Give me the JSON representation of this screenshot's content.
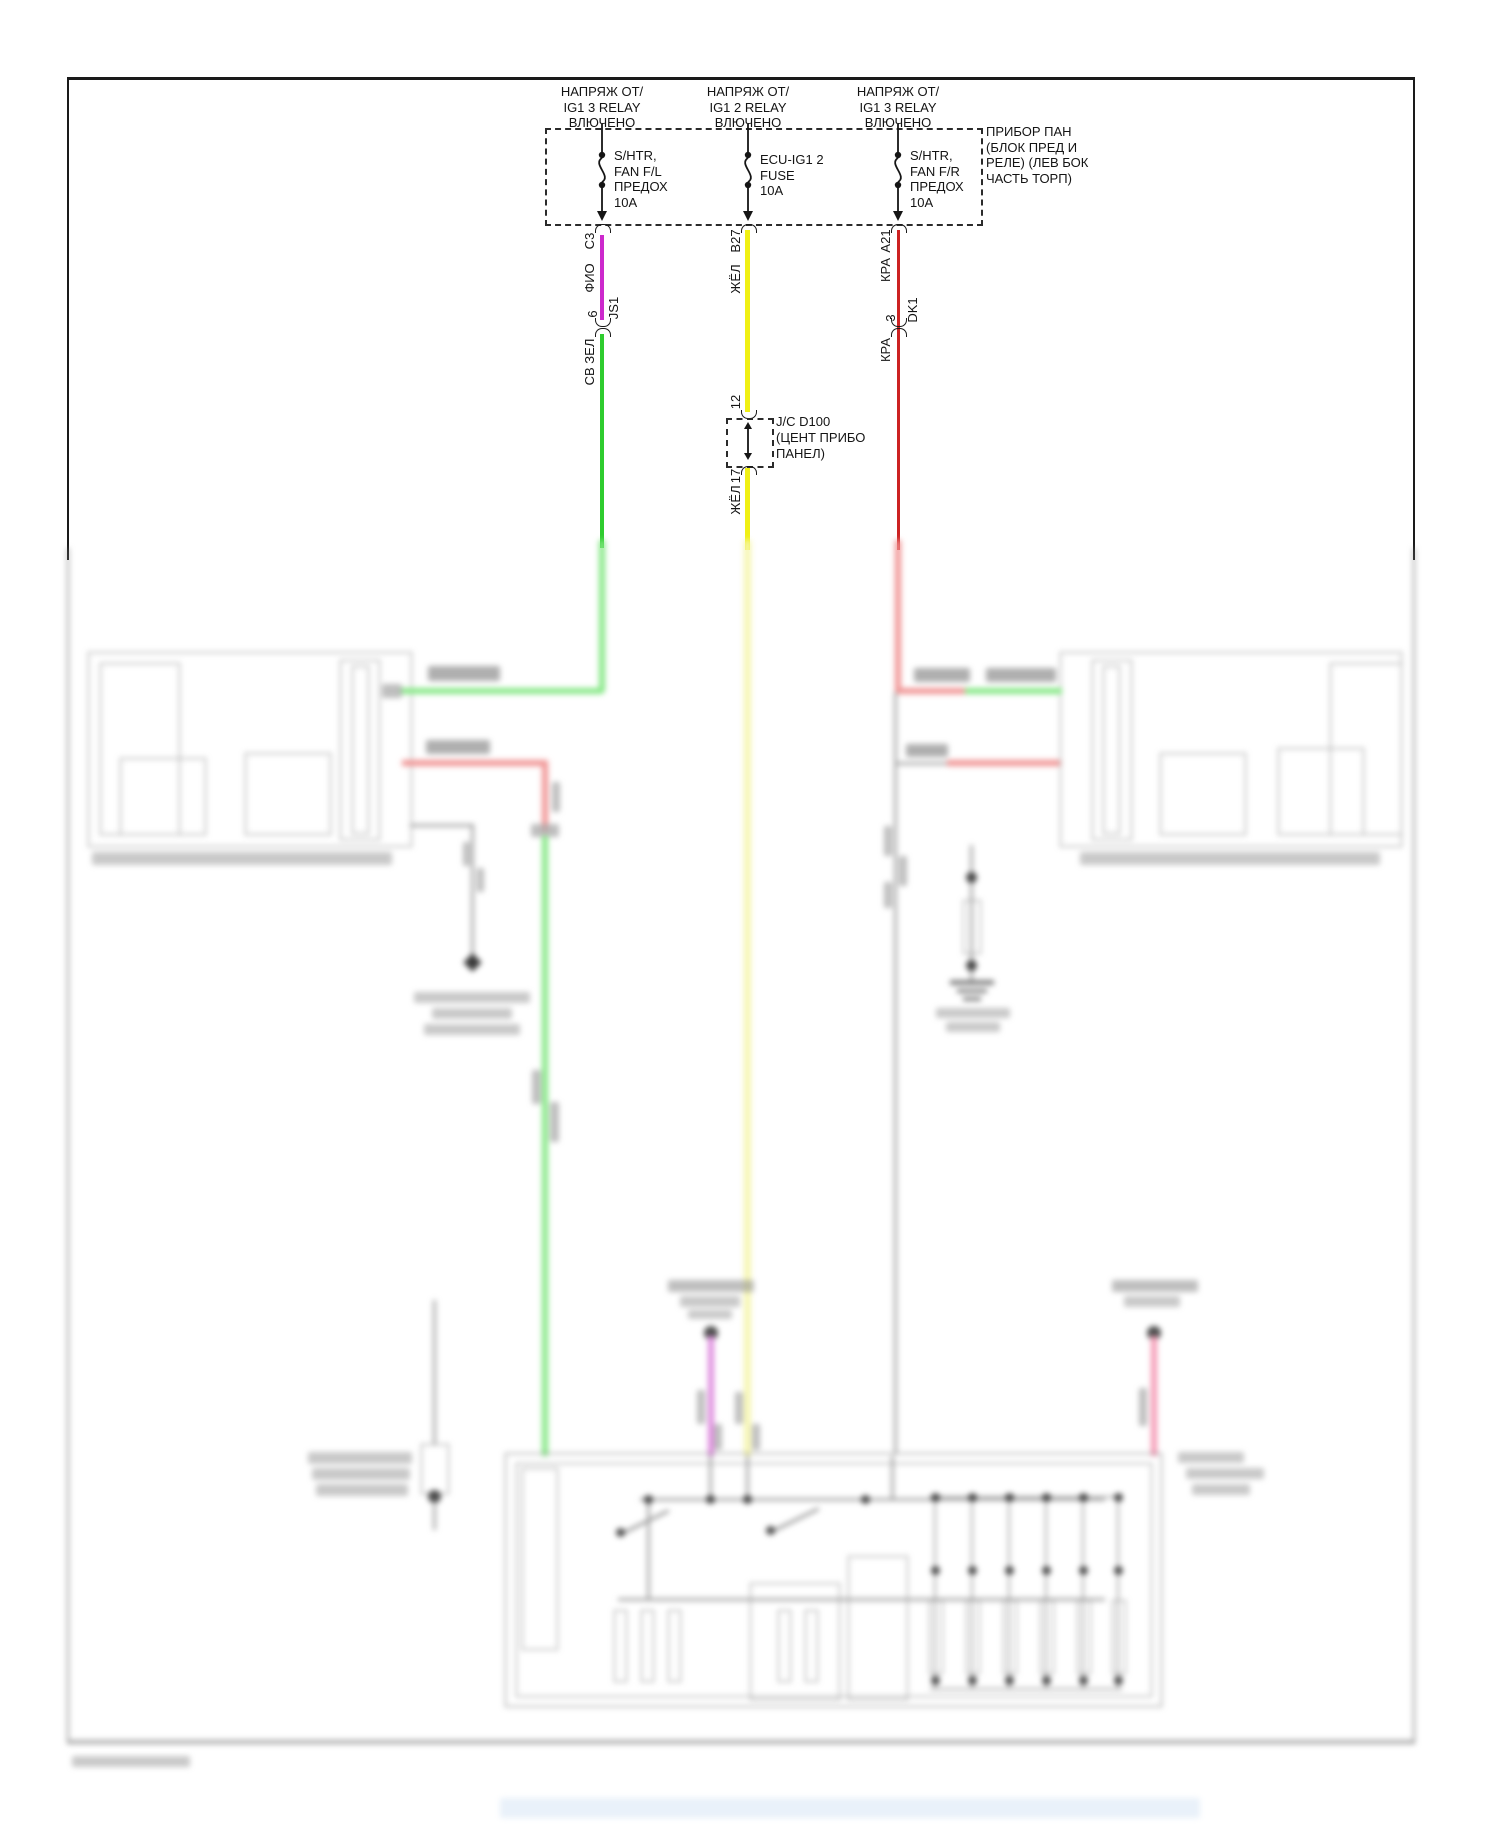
{
  "feeds": [
    {
      "source_lines": [
        "НАПРЯЖ ОТ/",
        "IG1 3 RELAY",
        "ВЛЮЧЕНО"
      ],
      "fuse_lines": [
        "S/HTR,",
        "FAN F/L",
        "ПРЕДОХ",
        "10A"
      ],
      "pin": "C3",
      "wire_color_1": "ФИО",
      "splice_pin": "6",
      "splice_name": "JS1",
      "wire_color_2": "СВ ЗЕЛ"
    },
    {
      "source_lines": [
        "НАПРЯЖ ОТ/",
        "IG1 2 RELAY",
        "ВЛЮЧЕНО"
      ],
      "fuse_lines": [
        "ECU-IG1 2",
        "FUSE",
        "10A"
      ],
      "pin": "B27",
      "wire_color_1": "ЖЁЛ",
      "junction_in": "12",
      "junction_out": "17",
      "wire_color_2": "ЖЁЛ"
    },
    {
      "source_lines": [
        "НАПРЯЖ ОТ/",
        "IG1 3 RELAY",
        "ВЛЮЧЕНО"
      ],
      "fuse_lines": [
        "S/HTR,",
        "FAN F/R",
        "ПРЕДОХ",
        "10A"
      ],
      "pin": "A21",
      "wire_color_1": "КРА",
      "splice_pin": "3",
      "splice_name": "DK1",
      "wire_color_2": "КРА"
    }
  ],
  "fuse_panel_label_lines": [
    "ПРИБОР ПАН",
    "(БЛОК ПРЕД И",
    "РЕЛЕ) (ЛЕВ БОК",
    "ЧАСТЬ ТОРП)"
  ],
  "junction_label_lines": [
    "J/C D100",
    "(ЦЕНТ ПРИБО",
    "ПАНЕЛ)"
  ],
  "colors": {
    "violet_wire": "#cc29cc",
    "green_wire": "#2ecc2e",
    "yellow_wire": "#f0f014",
    "red_wire": "#cc2222",
    "blur_green": "#86e886",
    "blur_red": "#f09595",
    "blur_yellow": "#f6f6b2",
    "blur_magenta": "#df8ddf",
    "blur_pink": "#f59ab5",
    "line_gray": "#9a9a9a"
  }
}
